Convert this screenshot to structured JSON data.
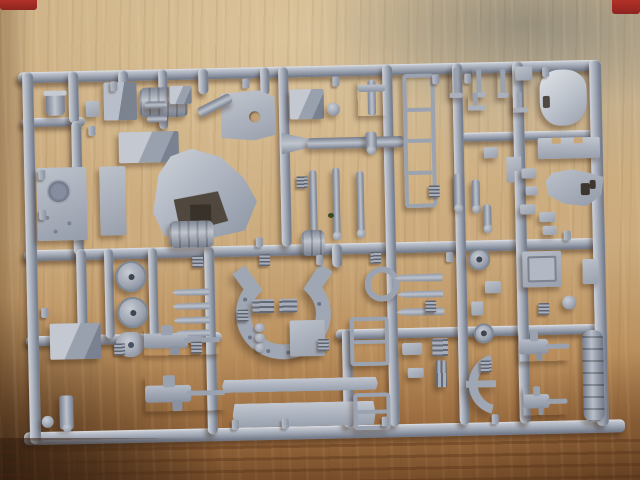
{
  "caption": "Photograph of a light-gray injection-molded plastic model kit sprue (parts tree with tank model components: turret shell, hull plates, gun barrels, road wheels, fender arc, side skirts, machine guns, small fittings) lying on a wooden table, slightly tilted, with red marks at the top corners",
  "photo": {
    "colors": {
      "plastic_light": "#c9ced6",
      "plastic_mid": "#9aa1af",
      "plastic_dark": "#6e7584",
      "wood_light": "#d8c49c",
      "wood_mid": "#c6a878",
      "wood_dark": "#8a5c33",
      "wood_darkest": "#3f2b1c",
      "red_mark": "#b13228",
      "shadow": "rgba(56,34,18,0.4)"
    },
    "red_marks": [
      {
        "name": "red-mark-top-left",
        "x": 0,
        "y": 0,
        "w": 37,
        "h": 10
      },
      {
        "name": "red-mark-top-right",
        "x": 612,
        "y": 0,
        "w": 28,
        "h": 14
      }
    ],
    "knot": {
      "name": "wood-knot",
      "x": 328,
      "y": 213,
      "w": 6,
      "h": 5,
      "color": "#3b4a22"
    },
    "sprue": {
      "x": 16,
      "y": 56,
      "w": 600,
      "h": 385,
      "rotate": -1.25,
      "rails": [
        [
          "top-rail",
          6,
          10,
          580,
          11,
          "h"
        ],
        [
          "left-step-rail",
          8,
          56,
          64,
          9,
          "h"
        ],
        [
          "right-upper-rail",
          448,
          80,
          140,
          9,
          "h"
        ],
        [
          "mid-rail",
          8,
          188,
          580,
          11,
          "h"
        ],
        [
          "low-rail-left",
          8,
          274,
          196,
          10,
          "h"
        ],
        [
          "low-rail-right",
          318,
          274,
          266,
          10,
          "h"
        ],
        [
          "bottom-rail",
          4,
          370,
          601,
          13,
          "h"
        ],
        [
          "left-rail",
          10,
          10,
          11,
          372,
          "v"
        ],
        [
          "right-rail",
          577,
          10,
          12,
          366,
          "v"
        ],
        [
          "runner-a-top",
          56,
          10,
          10,
          52,
          "v"
        ],
        [
          "runner-a-mid",
          58,
          60,
          10,
          134,
          "v"
        ],
        [
          "runner-a-low",
          60,
          188,
          10,
          94,
          "v"
        ],
        [
          "runner-b-stub",
          106,
          10,
          10,
          20,
          "v"
        ],
        [
          "runner-d",
          146,
          10,
          9,
          60,
          "v"
        ],
        [
          "runner-c-top",
          186,
          10,
          10,
          26,
          "v"
        ],
        [
          "runner-c-low",
          188,
          188,
          10,
          188,
          "v"
        ],
        [
          "runner-e-stub",
          248,
          10,
          9,
          28,
          "v"
        ],
        [
          "runner-f",
          266,
          10,
          10,
          180,
          "v"
        ],
        [
          "runner-g",
          316,
          188,
          10,
          24,
          "v"
        ],
        [
          "runner-g2",
          324,
          274,
          10,
          98,
          "v"
        ],
        [
          "runner-h",
          370,
          10,
          10,
          362,
          "v"
        ],
        [
          "runner-j",
          440,
          10,
          10,
          362,
          "v"
        ],
        [
          "runner-k",
          500,
          10,
          11,
          362,
          "v"
        ],
        [
          "wheel-runner-a",
          88,
          188,
          9,
          90,
          "v"
        ],
        [
          "wheel-runner-b",
          132,
          188,
          9,
          90,
          "v"
        ]
      ],
      "nubs": [
        [
          98,
          21
        ],
        [
          230,
          21
        ],
        [
          320,
          21
        ],
        [
          420,
          21
        ],
        [
          452,
          21
        ],
        [
          530,
          16
        ],
        [
          240,
          180
        ],
        [
          300,
          199
        ],
        [
          430,
          199
        ],
        [
          548,
          180
        ],
        [
          212,
          362
        ],
        [
          262,
          362
        ],
        [
          362,
          362
        ],
        [
          472,
          362
        ],
        [
          75,
          65
        ],
        [
          24,
          108
        ],
        [
          24,
          148
        ],
        [
          24,
          246
        ]
      ],
      "tabs": [
        [
          176,
          197
        ],
        [
          243,
          197
        ],
        [
          300,
          283
        ],
        [
          408,
          247
        ],
        [
          462,
          308
        ],
        [
          521,
          252
        ],
        [
          354,
          197
        ],
        [
          414,
          132
        ],
        [
          96,
          283
        ],
        [
          173,
          283
        ],
        [
          282,
          120
        ],
        [
          220,
          252
        ]
      ],
      "parts": [
        {
          "n": "cupola",
          "t": "cylv",
          "x": 33,
          "y": 29,
          "w": 19,
          "h": 25
        },
        {
          "n": "idler-drum",
          "t": "drum",
          "x": 127,
          "y": 28,
          "w": 48,
          "h": 30
        },
        {
          "n": "gearbox-cube",
          "t": "cube",
          "x": 91,
          "y": 22,
          "w": 33,
          "h": 38
        },
        {
          "n": "stowage-box",
          "t": "box3d",
          "x": 105,
          "y": 72,
          "w": 60,
          "h": 31
        },
        {
          "n": "small-bracket",
          "t": "rect",
          "x": 73,
          "y": 40,
          "w": 13,
          "h": 16
        },
        {
          "n": "hull-plate",
          "t": "hatchplate",
          "x": 22,
          "y": 106,
          "w": 50,
          "h": 73
        },
        {
          "n": "step-plate",
          "t": "plate",
          "x": 85,
          "y": 106,
          "w": 26,
          "h": 69
        },
        {
          "n": "block-part",
          "t": "box3d",
          "x": 157,
          "y": 27,
          "w": 22,
          "h": 18
        },
        {
          "n": "cross-rod-a",
          "t": "rodh",
          "x": 132,
          "y": 42,
          "w": 22,
          "h": 7
        },
        {
          "n": "cross-rod-b",
          "t": "rodh",
          "x": 134,
          "y": 56,
          "w": 20,
          "h": 7
        },
        {
          "n": "mount-plate",
          "t": "holeplate",
          "x": 208,
          "y": 33,
          "w": 54,
          "h": 50
        },
        {
          "n": "mount-arm",
          "t": "rodh",
          "x": 184,
          "y": 42,
          "w": 36,
          "h": 10,
          "r": -25
        },
        {
          "n": "turret-shell",
          "t": "turret",
          "x": 138,
          "y": 90,
          "w": 104,
          "h": 90
        },
        {
          "n": "open-bin",
          "t": "box3d",
          "x": 277,
          "y": 33,
          "w": 34,
          "h": 30
        },
        {
          "n": "knob-disc",
          "t": "circle",
          "x": 314,
          "y": 47,
          "w": 13,
          "h": 13
        },
        {
          "n": "periscope",
          "t": "tee",
          "x": 345,
          "y": 25,
          "w": 28,
          "h": 36
        },
        {
          "n": "gun-breech",
          "t": "cone",
          "x": 268,
          "y": 75,
          "w": 32,
          "h": 24
        },
        {
          "n": "gun-tube",
          "t": "rodh",
          "x": 294,
          "y": 82,
          "w": 96,
          "h": 11
        },
        {
          "n": "tube-collar",
          "t": "rodv",
          "x": 352,
          "y": 77,
          "w": 11,
          "h": 20
        },
        {
          "n": "track-guard-frame",
          "t": "framept",
          "x": 390,
          "y": 20,
          "w": 24,
          "h": 126,
          "rungs": 3
        },
        {
          "n": "rod-1",
          "t": "rodv",
          "x": 295,
          "y": 114,
          "w": 7,
          "h": 66
        },
        {
          "n": "rod-2",
          "t": "rodv",
          "x": 318,
          "y": 112,
          "w": 7,
          "h": 70
        },
        {
          "n": "rod-3",
          "t": "rodv",
          "x": 342,
          "y": 116,
          "w": 7,
          "h": 64
        },
        {
          "n": "hook-1",
          "t": "hook",
          "x": 437,
          "y": 15,
          "w": 13,
          "h": 30
        },
        {
          "n": "hook-2",
          "t": "hook",
          "x": 460,
          "y": 15,
          "w": 13,
          "h": 30
        },
        {
          "n": "hook-3",
          "t": "hook",
          "x": 485,
          "y": 17,
          "w": 11,
          "h": 29
        },
        {
          "n": "small-plate",
          "t": "plate",
          "x": 503,
          "y": 15,
          "w": 17,
          "h": 14
        },
        {
          "n": "hull-roof",
          "t": "roof",
          "x": 527,
          "y": 19,
          "w": 47,
          "h": 56
        },
        {
          "n": "bracket-a",
          "t": "hook",
          "x": 455,
          "y": 40,
          "w": 18,
          "h": 18
        },
        {
          "n": "bracket-b",
          "t": "hook",
          "x": 500,
          "y": 40,
          "w": 15,
          "h": 21
        },
        {
          "n": "glacis-plate",
          "t": "notchplate",
          "x": 524,
          "y": 87,
          "w": 62,
          "h": 21
        },
        {
          "n": "flag-part",
          "t": "flag",
          "x": 492,
          "y": 105,
          "w": 15,
          "h": 26
        },
        {
          "n": "bit-1",
          "t": "rect",
          "x": 507,
          "y": 117,
          "w": 15,
          "h": 10
        },
        {
          "n": "bit-2",
          "t": "rect",
          "x": 511,
          "y": 135,
          "w": 12,
          "h": 9
        },
        {
          "n": "bit-3",
          "t": "rect",
          "x": 505,
          "y": 153,
          "w": 15,
          "h": 10
        },
        {
          "n": "gun-cradle",
          "t": "blob",
          "x": 531,
          "y": 119,
          "w": 58,
          "h": 37
        },
        {
          "n": "thin-rod-a",
          "t": "rodv",
          "x": 439,
          "y": 121,
          "w": 9,
          "h": 36
        },
        {
          "n": "thin-rod-b",
          "t": "rodv",
          "x": 457,
          "y": 127,
          "w": 8,
          "h": 31
        },
        {
          "n": "thin-rod-c",
          "t": "rodv",
          "x": 468,
          "y": 152,
          "w": 8,
          "h": 26
        },
        {
          "n": "upper-tab",
          "t": "rect",
          "x": 470,
          "y": 95,
          "w": 14,
          "h": 11
        },
        {
          "n": "dome-small",
          "t": "wheel",
          "x": 452,
          "y": 196,
          "w": 18,
          "h": 18
        },
        {
          "n": "square-box",
          "t": "sqbox",
          "x": 506,
          "y": 200,
          "w": 39,
          "h": 36
        },
        {
          "n": "rail-bracket",
          "t": "rect",
          "x": 566,
          "y": 209,
          "w": 16,
          "h": 25
        },
        {
          "n": "bit-4",
          "t": "rect",
          "x": 524,
          "y": 161,
          "w": 16,
          "h": 10
        },
        {
          "n": "bit-5",
          "t": "rect",
          "x": 527,
          "y": 175,
          "w": 14,
          "h": 9
        },
        {
          "n": "rib-drum",
          "t": "drum",
          "x": 154,
          "y": 162,
          "w": 44,
          "h": 27
        },
        {
          "n": "road-wheel-1",
          "t": "wheel",
          "x": 99,
          "y": 201,
          "w": 27,
          "h": 27
        },
        {
          "n": "road-wheel-2",
          "t": "wheel",
          "x": 100,
          "y": 237,
          "w": 27,
          "h": 27
        },
        {
          "n": "drum-wheel",
          "t": "drum",
          "x": 286,
          "y": 174,
          "w": 23,
          "h": 26
        },
        {
          "n": "ring-mount",
          "t": "ring",
          "x": 348,
          "y": 212,
          "w": 23,
          "h": 23
        },
        {
          "n": "tow-spike-1",
          "t": "spike",
          "x": 155,
          "y": 230,
          "w": 37,
          "h": 7
        },
        {
          "n": "tow-spike-2",
          "t": "spike",
          "x": 155,
          "y": 244,
          "w": 37,
          "h": 7
        },
        {
          "n": "tow-spike-3",
          "t": "spike",
          "x": 156,
          "y": 258,
          "w": 36,
          "h": 7
        },
        {
          "n": "tow-spike-4",
          "t": "spike",
          "x": 157,
          "y": 271,
          "w": 35,
          "h": 7
        },
        {
          "n": "keyhole-part",
          "t": "keyhole",
          "x": 98,
          "y": 272,
          "w": 29,
          "h": 25
        },
        {
          "n": "tool-box",
          "t": "box3d",
          "x": 32,
          "y": 262,
          "w": 51,
          "h": 36
        },
        {
          "n": "mg-upper",
          "t": "gun",
          "x": 126,
          "y": 266,
          "w": 76,
          "h": 30
        },
        {
          "n": "mg-lower",
          "t": "gun",
          "x": 126,
          "y": 316,
          "w": 80,
          "h": 36
        },
        {
          "n": "knob-rod",
          "t": "rodv",
          "x": 40,
          "y": 334,
          "w": 14,
          "h": 34
        },
        {
          "n": "disc-small",
          "t": "circle",
          "x": 22,
          "y": 354,
          "w": 12,
          "h": 12
        },
        {
          "n": "fender-arc",
          "t": "arc",
          "x": 198,
          "y": 208,
          "w": 135,
          "h": 96
        },
        {
          "n": "rib-block-a",
          "t": "tabbig",
          "x": 235,
          "y": 242,
          "w": 22,
          "h": 14
        },
        {
          "n": "rib-block-b",
          "t": "tabbig",
          "x": 262,
          "y": 242,
          "w": 18,
          "h": 14
        },
        {
          "n": "link-chain",
          "t": "chain",
          "x": 237,
          "y": 266,
          "w": 14,
          "h": 30
        },
        {
          "n": "square-plate",
          "t": "plate",
          "x": 272,
          "y": 264,
          "w": 35,
          "h": 36
        },
        {
          "n": "skirt-strip",
          "t": "strip",
          "x": 203,
          "y": 322,
          "w": 156,
          "h": 13
        },
        {
          "n": "skirt-panel",
          "t": "strip",
          "x": 213,
          "y": 346,
          "w": 143,
          "h": 24
        },
        {
          "n": "frame-small",
          "t": "framept",
          "x": 332,
          "y": 262,
          "w": 31,
          "h": 41,
          "rungs": 1
        },
        {
          "n": "ladder-small",
          "t": "framept",
          "x": 334,
          "y": 338,
          "w": 29,
          "h": 29,
          "rungs": 1
        },
        {
          "n": "bit-6",
          "t": "rect",
          "x": 384,
          "y": 289,
          "w": 20,
          "h": 12
        },
        {
          "n": "bit-7",
          "t": "rect",
          "x": 389,
          "y": 314,
          "w": 16,
          "h": 10
        },
        {
          "n": "pin-rod-1",
          "t": "spike",
          "x": 378,
          "y": 220,
          "w": 48,
          "h": 8
        },
        {
          "n": "pin-rod-2",
          "t": "spike",
          "x": 380,
          "y": 237,
          "w": 46,
          "h": 7
        },
        {
          "n": "pin-rod-3",
          "t": "spike",
          "x": 379,
          "y": 254,
          "w": 48,
          "h": 8
        },
        {
          "n": "quarter-arc",
          "t": "arcq",
          "x": 439,
          "y": 301,
          "w": 44,
          "h": 62
        },
        {
          "n": "disc-part",
          "t": "wheel",
          "x": 456,
          "y": 271,
          "w": 16,
          "h": 16
        },
        {
          "n": "letter-tab",
          "t": "tabbig",
          "x": 414,
          "y": 285,
          "w": 16,
          "h": 18
        },
        {
          "n": "code-tab",
          "t": "tabv",
          "x": 417,
          "y": 307,
          "w": 11,
          "h": 27
        },
        {
          "n": "mg-mount-upper",
          "t": "gun",
          "x": 501,
          "y": 279,
          "w": 50,
          "h": 31
        },
        {
          "n": "mg-mount-lower",
          "t": "gun",
          "x": 504,
          "y": 335,
          "w": 44,
          "h": 29
        },
        {
          "n": "ribbed-barrel",
          "t": "cylribv",
          "x": 564,
          "y": 280,
          "w": 21,
          "h": 92
        },
        {
          "n": "disc-right",
          "t": "circle",
          "x": 545,
          "y": 245,
          "w": 14,
          "h": 14
        },
        {
          "n": "bit-8",
          "t": "rect",
          "x": 468,
          "y": 229,
          "w": 16,
          "h": 12
        },
        {
          "n": "bit-9",
          "t": "rect",
          "x": 454,
          "y": 249,
          "w": 12,
          "h": 14
        }
      ]
    }
  }
}
